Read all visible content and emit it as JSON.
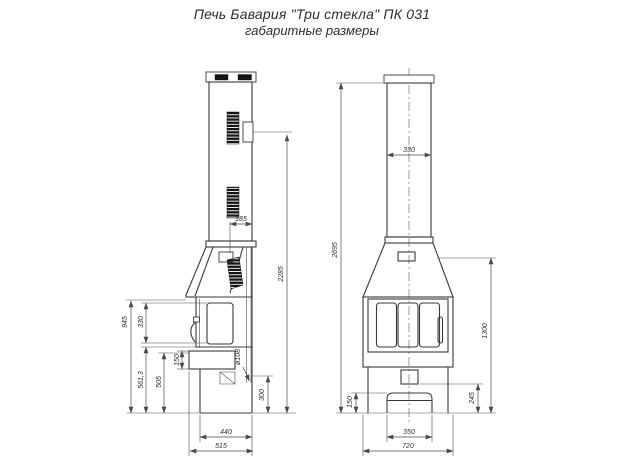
{
  "title": {
    "line1": "Печь Бавария \"Три стекла\" ПК 031",
    "line2": "габаритные размеры"
  },
  "colors": {
    "line": "#3a3a3a",
    "background": "#ffffff"
  },
  "side_view": {
    "label": "вид сбоку",
    "dims": {
      "flue_offset": "185",
      "height_to_flue_outlet": "2285",
      "glass_height": "330",
      "door_top_height": "945",
      "door_bottom_height": "561,3",
      "shelf_top_height": "505",
      "shelf_thickness": "150",
      "pipe_diameter": "ø108",
      "rear_outlet_height": "300",
      "body_depth": "440",
      "overall_depth": "515"
    }
  },
  "front_view": {
    "label": "вид спереди",
    "dims": {
      "chimney_width": "330",
      "overall_height": "2695",
      "firebox_top_height": "1300",
      "base_step_height": "245",
      "ash_drawer_height": "150",
      "ash_drawer_width": "350",
      "overall_width": "720"
    }
  }
}
